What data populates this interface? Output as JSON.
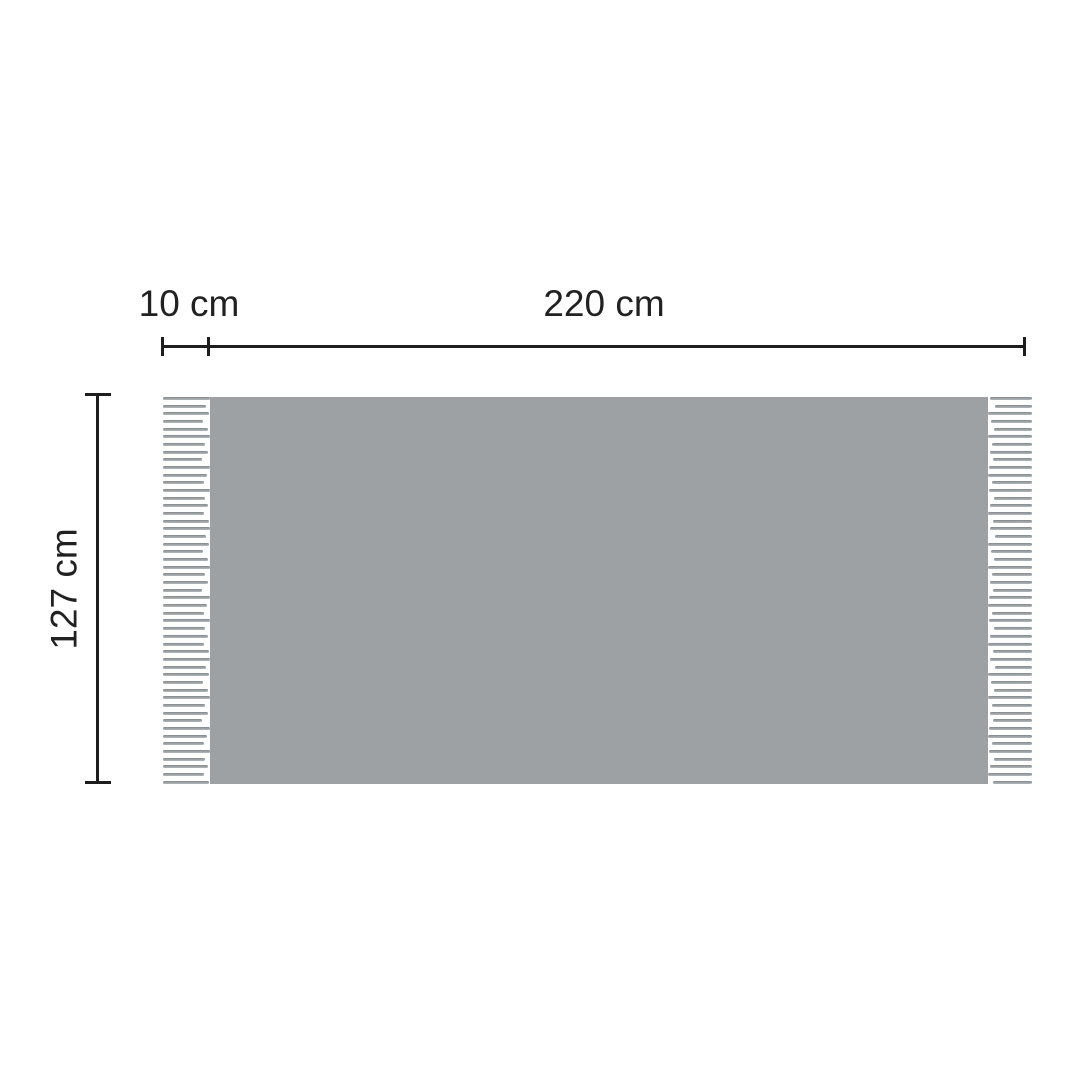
{
  "diagram": {
    "object": "blanket-with-fringe-dimension-diagram",
    "labels": {
      "fringe_width": "10 cm",
      "body_width": "220 cm",
      "height": "127 cm"
    },
    "colors": {
      "background": "#ffffff",
      "body": "#9da1a4",
      "strand_dark": "#82868a",
      "strand_mid": "#9aa0a3",
      "strand_light": "#b2b7ba",
      "line": "#1d1d1d",
      "text": "#212121"
    },
    "fringe": {
      "strand_count": 51
    }
  }
}
